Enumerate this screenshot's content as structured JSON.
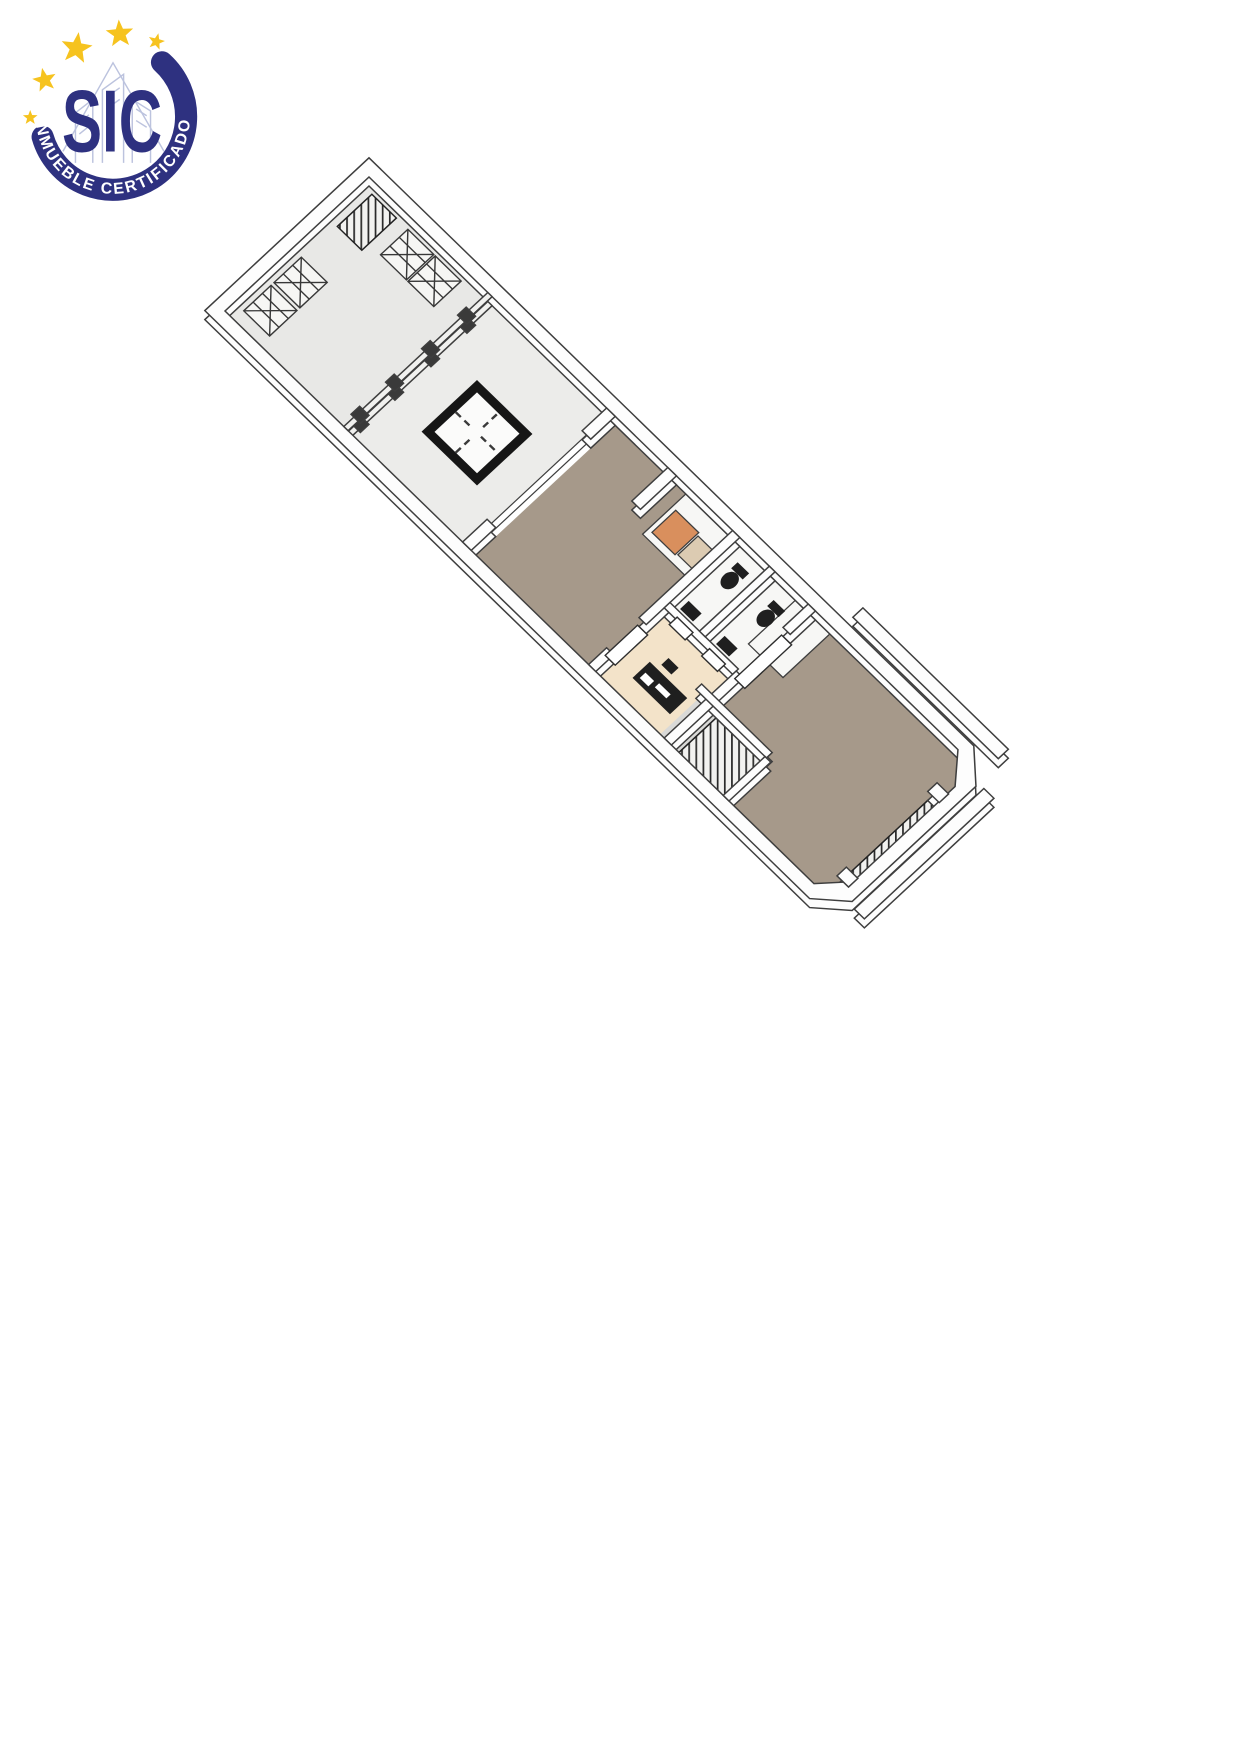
{
  "page": {
    "background": "#ffffff"
  },
  "logo_badge": {
    "acronym": "SIC",
    "tagline": "INMUEBLE CERTIFICADO",
    "star_count": 5,
    "colors": {
      "navy": "#2e3180",
      "star_yellow": "#f6c31f",
      "sketch_lines": "#b9c0dd",
      "tagline_text": "#ffffff"
    }
  },
  "floor_plan": {
    "view": "3D axonometric floor plan of an elongated property",
    "colors": {
      "outline": "#3e3e3e",
      "wall_fill": "#fdfdfd",
      "floor_light_gray": "#e8e8e6",
      "floor_patio_gray": "#ececea",
      "floor_brown": "#a6998a",
      "floor_cream": "#f3e3c9",
      "bath_floor_white": "#f7f7f5",
      "counter_orange": "#d98f5d",
      "counter_beige": "#dccbb2",
      "landing_gray": "#d9d9d7",
      "fixture_dark": "#1f1f1f",
      "hatch_dark": "#2b2b2b",
      "skylight_frame": "#161616"
    }
  }
}
